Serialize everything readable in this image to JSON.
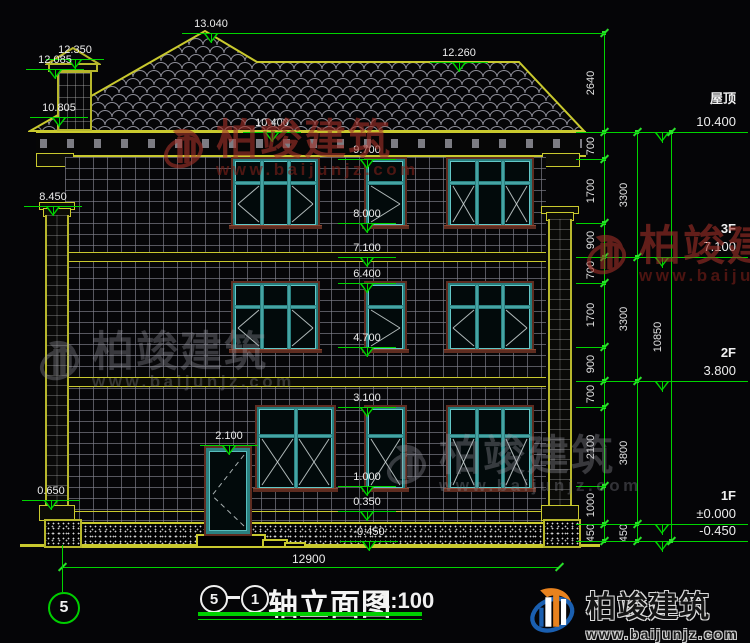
{
  "colors": {
    "green": "#00d400",
    "yellow": "#c9c92e",
    "teal": "#2a8080",
    "wm_red": "#b03028",
    "wm_gray": "#9a9aa4",
    "bg": "#050507"
  },
  "markers": {
    "left": [
      "12.350",
      "12.085",
      "10.805",
      "8.450",
      "0.650"
    ],
    "center": [
      "13.040",
      "12.260",
      "10.400",
      "9.700",
      "8.000",
      "7.100",
      "6.400",
      "4.700",
      "3.100",
      "2.100",
      "1.000",
      "0.350",
      "-0.450"
    ]
  },
  "right_levels": [
    {
      "label": "屋顶",
      "value": "10.400"
    },
    {
      "label": "3F",
      "value": "7.100"
    },
    {
      "label": "2F",
      "value": "3.800"
    },
    {
      "label": "1F",
      "value": "±0.000"
    },
    {
      "label": "",
      "value": "-0.450"
    }
  ],
  "dim_chains": {
    "inner": [
      "2640",
      "700",
      "1700",
      "900",
      "700",
      "1700",
      "900",
      "700",
      "2100",
      "1000",
      "450"
    ],
    "middle": [
      "3300",
      "3300",
      "3800",
      "450"
    ],
    "outer": [
      "10850"
    ]
  },
  "bottom": {
    "overall_dim": "12900",
    "axis_bubble": "5"
  },
  "title": {
    "axis_start": "5",
    "axis_end": "1",
    "name": "轴立面图",
    "scale": "1:100"
  },
  "watermark": {
    "brand": "柏竣建筑",
    "site": "www.baijunjz.com"
  },
  "logo": {
    "brand": "柏竣建筑",
    "site": "www.baijunjz.com"
  }
}
